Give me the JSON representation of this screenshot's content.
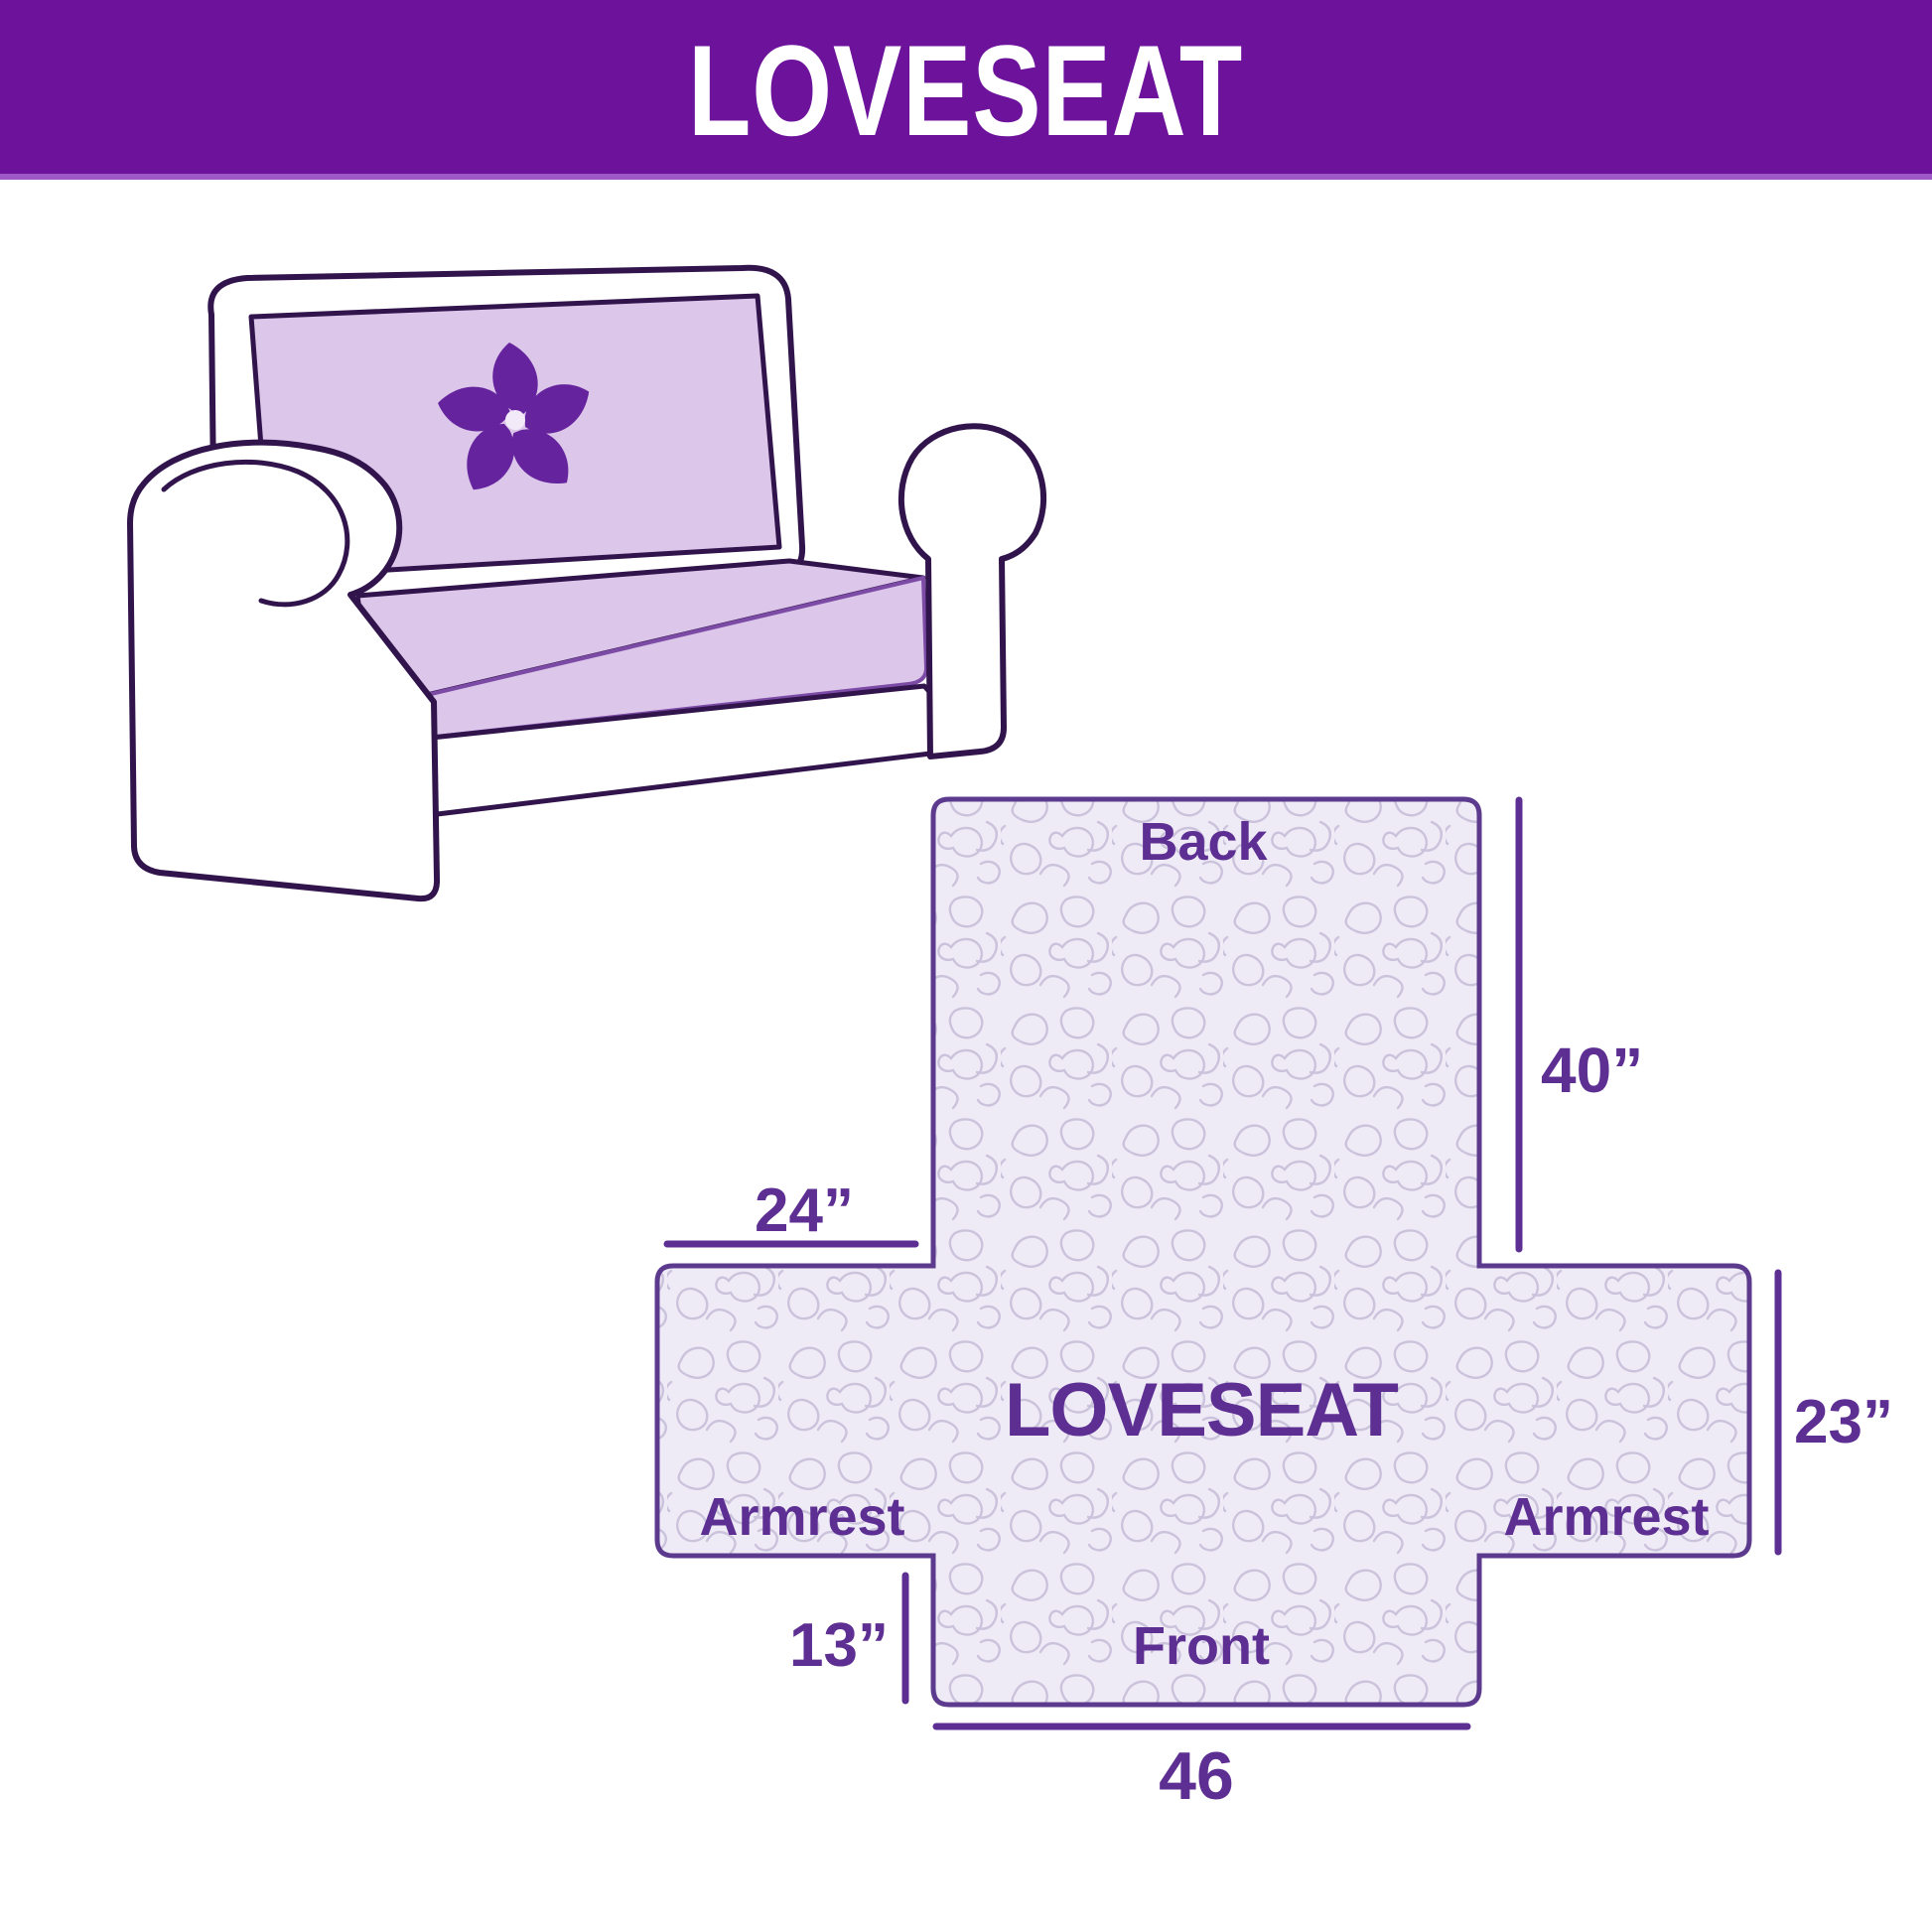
{
  "header": {
    "title": "LOVESEAT"
  },
  "illustration": {
    "logo_icon": "pinwheel-flower-logo",
    "cover_color": "#dcc6ea",
    "outline_color": "#32144d",
    "logo_color": "#65249e"
  },
  "diagram": {
    "center_label": "LOVESEAT",
    "back_label": "Back",
    "front_label": "Front",
    "armrest_left_label": "Armrest",
    "armrest_right_label": "Armrest",
    "dimensions": {
      "back_height": "40”",
      "armrest_top_width": "24”",
      "armrest_side_height": "23”",
      "front_skirt_height": "13”",
      "front_width": "46"
    },
    "colors": {
      "header_bg": "#6c129b",
      "header_divider": "#9d5ac6",
      "label_text": "#5e2f93",
      "shape_outline": "#5c3b8e",
      "fabric_fill": "#eeebf6",
      "quilt_line": "#cbc2dc"
    }
  }
}
